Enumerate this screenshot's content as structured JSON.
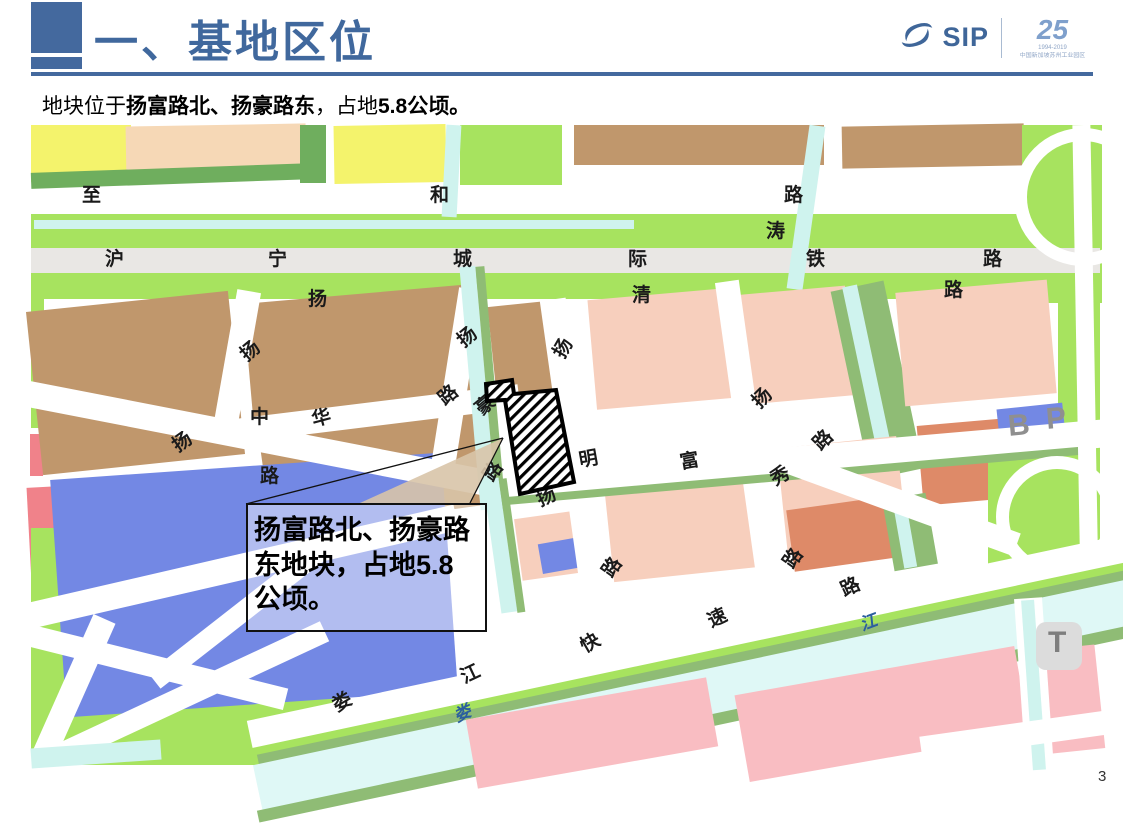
{
  "slide": {
    "title": "一、基地区位",
    "subtitle_segments": [
      {
        "text": "地块位于",
        "bold": false
      },
      {
        "text": "扬富路北、扬豪路东",
        "bold": true
      },
      {
        "text": "，占地",
        "bold": false
      },
      {
        "text": "5.8公顷。",
        "bold": true
      }
    ],
    "page_number": "3",
    "accent_color": "#44699E"
  },
  "logo": {
    "name": "SIP",
    "anniversary": "25",
    "anniversary_dates": "1994-2019",
    "anniversary_caption": "中国新加坡苏州工业园区",
    "color": "#3F6699",
    "light_color": "#7FA0CC"
  },
  "map": {
    "callout_text": "扬富路北、扬豪路东地块，占地5.8公顷。",
    "parcel": {
      "hatch_color": "#000000",
      "outline_color": "#000000",
      "fill": "#ffffff"
    },
    "palette": {
      "yellow": "#F4F36C",
      "peach": "#F6D8B6",
      "light_green": "#A7E35F",
      "dark_green": "#6FAE5E",
      "mid_green": "#8FBC75",
      "brown": "#C0976C",
      "blue": "#7388E4",
      "pink": "#F7CFBD",
      "rose": "#F9BDC2",
      "salmon": "#DE8A68",
      "red": "#F0828A",
      "canal": "#CFF3EE",
      "river": "#DFF8F6",
      "railway": "#E9E7E4",
      "road": "#FFFFFF",
      "badge": "#DCDCDC"
    },
    "blocks": [
      {
        "x": 31,
        "y": 125,
        "w": 100,
        "h": 57,
        "c": "#F4F36C"
      },
      {
        "x": 126,
        "y": 125,
        "w": 180,
        "h": 53,
        "c": "#F6D8B6",
        "r": -1
      },
      {
        "x": 31,
        "y": 168,
        "w": 282,
        "h": 16,
        "c": "#6FAE5E",
        "r": -2
      },
      {
        "x": 300,
        "y": 125,
        "w": 26,
        "h": 58,
        "c": "#6FAE5E"
      },
      {
        "x": 334,
        "y": 125,
        "w": 112,
        "h": 58,
        "c": "#F4F36C",
        "r": -1
      },
      {
        "x": 460,
        "y": 125,
        "w": 102,
        "h": 60,
        "c": "#A7E35F"
      },
      {
        "x": 574,
        "y": 125,
        "w": 250,
        "h": 40,
        "c": "#C0976C"
      },
      {
        "x": 842,
        "y": 125,
        "w": 182,
        "h": 42,
        "c": "#C0976C",
        "r": -1
      },
      {
        "x": 1022,
        "y": 125,
        "w": 80,
        "h": 178,
        "c": "#A7E35F"
      },
      {
        "x": 31,
        "y": 214,
        "w": 1069,
        "h": 34,
        "c": "#A7E35F"
      },
      {
        "x": 34,
        "y": 220,
        "w": 600,
        "h": 9,
        "c": "#CFF3EE"
      },
      {
        "x": 444,
        "y": 125,
        "w": 15,
        "h": 92,
        "c": "#CFF3EE",
        "r": 3
      },
      {
        "x": 31,
        "y": 248,
        "w": 1069,
        "h": 25,
        "c": "#E9E7E4",
        "n": "railway"
      },
      {
        "x": 31,
        "y": 273,
        "w": 1069,
        "h": 26,
        "c": "#A7E35F"
      },
      {
        "x": 798,
        "y": 125,
        "w": 16,
        "h": 165,
        "c": "#CFF3EE",
        "r": 8
      },
      {
        "x": 31,
        "y": 296,
        "w": 13,
        "h": 132,
        "c": "#A7E35F"
      },
      {
        "x": 30,
        "y": 434,
        "w": 13,
        "h": 42,
        "c": "#F0828A"
      },
      {
        "x": 30,
        "y": 487,
        "w": 28,
        "h": 133,
        "c": "#F0828A",
        "r": -3
      },
      {
        "x": 31,
        "y": 528,
        "w": 302,
        "h": 237,
        "c": "#A7E35F"
      },
      {
        "x": 34,
        "y": 301,
        "w": 203,
        "h": 164,
        "c": "#C0976C",
        "r": -6
      },
      {
        "x": 248,
        "y": 294,
        "w": 224,
        "h": 120,
        "c": "#C0976C",
        "r": -5
      },
      {
        "x": 264,
        "y": 414,
        "w": 218,
        "h": 106,
        "c": "#C0976C",
        "r": -8
      },
      {
        "x": 492,
        "y": 304,
        "w": 56,
        "h": 90,
        "c": "#C0976C",
        "r": -6
      },
      {
        "x": 58,
        "y": 466,
        "w": 392,
        "h": 238,
        "c": "#7388E4",
        "r": -4
      },
      {
        "x": 592,
        "y": 294,
        "w": 138,
        "h": 110,
        "c": "#F7CFBD",
        "r": -5
      },
      {
        "x": 744,
        "y": 290,
        "w": 106,
        "h": 110,
        "c": "#F7CFBD",
        "r": -5
      },
      {
        "x": 850,
        "y": 284,
        "w": 54,
        "h": 192,
        "c": "#8FBC75",
        "r": -12
      },
      {
        "x": 862,
        "y": 284,
        "w": 15,
        "h": 192,
        "c": "#CFF3EE",
        "r": -12
      },
      {
        "x": 900,
        "y": 286,
        "w": 152,
        "h": 114,
        "c": "#F7CFBD",
        "r": -5
      },
      {
        "x": 1058,
        "y": 275,
        "w": 42,
        "h": 300,
        "c": "#A7E35F"
      },
      {
        "x": 608,
        "y": 464,
        "w": 162,
        "h": 110,
        "c": "#F7CFBD",
        "r": -6
      },
      {
        "x": 782,
        "y": 442,
        "w": 120,
        "h": 106,
        "c": "#F7CFBD",
        "r": -6
      },
      {
        "x": 518,
        "y": 514,
        "w": 72,
        "h": 62,
        "c": "#F7CFBD",
        "r": -8
      },
      {
        "x": 540,
        "y": 540,
        "w": 48,
        "h": 30,
        "c": "#7388E4",
        "r": -10
      },
      {
        "x": 920,
        "y": 422,
        "w": 88,
        "h": 80,
        "c": "#DE8A68",
        "r": -5
      },
      {
        "x": 1072,
        "y": 422,
        "w": 26,
        "h": 66,
        "c": "#DE8A68",
        "r": -5
      },
      {
        "x": 988,
        "y": 436,
        "w": 112,
        "h": 150,
        "c": "#A7E35F"
      },
      {
        "x": 998,
        "y": 406,
        "w": 66,
        "h": 32,
        "c": "#7388E4",
        "r": -6
      },
      {
        "x": 790,
        "y": 503,
        "w": 102,
        "h": 62,
        "c": "#DE8A68",
        "r": -8
      },
      {
        "x": 888,
        "y": 496,
        "w": 44,
        "h": 72,
        "c": "#8FBC75",
        "r": -10
      },
      {
        "x": 898,
        "y": 496,
        "w": 13,
        "h": 72,
        "c": "#CFF3EE",
        "r": -10
      },
      {
        "x": 224,
        "y": 290,
        "w": 24,
        "h": 152,
        "c": "#FFFFFF",
        "r": 10,
        "n": "road"
      },
      {
        "x": 444,
        "y": 288,
        "w": 24,
        "h": 192,
        "c": "#FFFFFF",
        "r": 9,
        "n": "road"
      },
      {
        "x": 228,
        "y": 402,
        "w": 292,
        "h": 24,
        "c": "#FFFFFF",
        "r": -7,
        "n": "road"
      },
      {
        "x": 8,
        "y": 424,
        "w": 484,
        "h": 26,
        "c": "#FFFFFF",
        "r": 11,
        "n": "road"
      },
      {
        "x": 20,
        "y": 554,
        "w": 442,
        "h": 26,
        "c": "#FFFFFF",
        "r": -13,
        "n": "road"
      },
      {
        "x": 560,
        "y": 298,
        "w": 26,
        "h": 292,
        "c": "#FFFFFF",
        "r": -8,
        "n": "road"
      },
      {
        "x": 736,
        "y": 280,
        "w": 24,
        "h": 304,
        "c": "#FFFFFF",
        "r": -8,
        "n": "road"
      },
      {
        "x": 494,
        "y": 446,
        "w": 612,
        "h": 28,
        "c": "#FFFFFF",
        "r": -5,
        "n": "road"
      },
      {
        "x": 492,
        "y": 472,
        "w": 600,
        "h": 8,
        "c": "#8FBC75",
        "r": -5
      },
      {
        "x": 780,
        "y": 491,
        "w": 244,
        "h": 24,
        "c": "#FFFFFF",
        "r": 20,
        "n": "road"
      },
      {
        "x": 1014,
        "y": 128,
        "w": 112,
        "h": 112,
        "ring": true,
        "n": "ramp"
      },
      {
        "x": 996,
        "y": 456,
        "w": 96,
        "h": 96,
        "ring": true,
        "n": "interchange-loop"
      },
      {
        "x": 1078,
        "y": 125,
        "w": 18,
        "h": 645,
        "c": "#FFFFFF",
        "r": -1,
        "n": "road"
      },
      {
        "x": 470,
        "y": 266,
        "w": 16,
        "h": 244,
        "c": "#CFF3EE",
        "r": -5,
        "n": "canal"
      },
      {
        "x": 486,
        "y": 266,
        "w": 9,
        "h": 244,
        "c": "#8FBC75",
        "r": -5
      },
      {
        "x": 492,
        "y": 478,
        "w": 16,
        "h": 135,
        "c": "#CFF3EE",
        "r": -8,
        "n": "canal"
      },
      {
        "x": 508,
        "y": 478,
        "w": 8,
        "h": 135,
        "c": "#8FBC75",
        "r": -8
      },
      {
        "x": -10,
        "y": 652,
        "w": 300,
        "h": 22,
        "c": "#FFFFFF",
        "r": 14,
        "n": "road"
      },
      {
        "x": 60,
        "y": 612,
        "w": 24,
        "h": 160,
        "c": "#FFFFFF",
        "r": 24,
        "n": "road"
      },
      {
        "x": 10,
        "y": 690,
        "w": 330,
        "h": 22,
        "c": "#FFFFFF",
        "r": -25,
        "n": "road"
      },
      {
        "x": 130,
        "y": 600,
        "w": 230,
        "h": 20,
        "c": "#FFFFFF",
        "r": -38,
        "n": "road"
      },
      {
        "x": 240,
        "y": 626,
        "w": 910,
        "h": 30,
        "c": "#FFFFFF",
        "r": -12,
        "n": "expressway"
      },
      {
        "x": 240,
        "y": 654,
        "w": 910,
        "h": 10,
        "c": "#A7E35F",
        "r": -12
      },
      {
        "x": 248,
        "y": 658,
        "w": 930,
        "h": 12,
        "c": "#8FBC75",
        "r": -12
      },
      {
        "x": 248,
        "y": 668,
        "w": 930,
        "h": 50,
        "c": "#DFF8F6",
        "r": -12,
        "n": "river"
      },
      {
        "x": 248,
        "y": 714,
        "w": 930,
        "h": 12,
        "c": "#8FBC75",
        "r": -12
      },
      {
        "x": 470,
        "y": 698,
        "w": 244,
        "h": 70,
        "c": "#F9BDC2",
        "r": -10
      },
      {
        "x": 740,
        "y": 670,
        "w": 284,
        "h": 88,
        "c": "#F9BDC2",
        "r": -10
      },
      {
        "x": 1028,
        "y": 648,
        "w": 72,
        "h": 104,
        "c": "#F9BDC2",
        "r": -6
      },
      {
        "x": 1020,
        "y": 598,
        "w": 28,
        "h": 172,
        "c": "#FFFFFF",
        "r": -4,
        "n": "road"
      },
      {
        "x": 1027,
        "y": 600,
        "w": 13,
        "h": 170,
        "c": "#CFF3EE",
        "r": -4
      },
      {
        "x": 1036,
        "y": 622,
        "w": 46,
        "h": 48,
        "c": "#DCDCDC",
        "rad": 10,
        "n": "transit-badge"
      },
      {
        "x": 920,
        "y": 722,
        "w": 210,
        "h": 24,
        "c": "#FFFFFF",
        "r": -8,
        "n": "road"
      },
      {
        "x": 31,
        "y": 744,
        "w": 130,
        "h": 20,
        "c": "#CFF3EE",
        "r": -4
      }
    ],
    "labels": [
      {
        "t": "至",
        "x": 82,
        "y": 186
      },
      {
        "t": "和",
        "x": 430,
        "y": 186
      },
      {
        "t": "路",
        "x": 784,
        "y": 186
      },
      {
        "t": "涛",
        "x": 766,
        "y": 222
      },
      {
        "t": "沪",
        "x": 105,
        "y": 250,
        "b": true
      },
      {
        "t": "宁",
        "x": 268,
        "y": 250,
        "b": true
      },
      {
        "t": "城",
        "x": 453,
        "y": 250,
        "b": true
      },
      {
        "t": "际",
        "x": 628,
        "y": 250,
        "b": true
      },
      {
        "t": "铁",
        "x": 806,
        "y": 250,
        "b": true
      },
      {
        "t": "路",
        "x": 983,
        "y": 250,
        "b": true
      },
      {
        "t": "扬",
        "x": 308,
        "y": 290
      },
      {
        "t": "清",
        "x": 632,
        "y": 286
      },
      {
        "t": "路",
        "x": 944,
        "y": 281
      },
      {
        "t": "扬",
        "x": 241,
        "y": 342,
        "r": -40
      },
      {
        "t": "扬",
        "x": 458,
        "y": 328,
        "r": -40
      },
      {
        "t": "扬",
        "x": 554,
        "y": 339,
        "r": -60
      },
      {
        "t": "路",
        "x": 439,
        "y": 386,
        "r": -40
      },
      {
        "t": "豪",
        "x": 476,
        "y": 396,
        "r": -40
      },
      {
        "t": "中",
        "x": 250,
        "y": 408
      },
      {
        "t": "华",
        "x": 312,
        "y": 409,
        "r": -15
      },
      {
        "t": "扬",
        "x": 173,
        "y": 433,
        "r": -35
      },
      {
        "t": "扬",
        "x": 753,
        "y": 389,
        "r": -45
      },
      {
        "t": "路",
        "x": 260,
        "y": 467
      },
      {
        "t": "路",
        "x": 484,
        "y": 462,
        "r": -55
      },
      {
        "t": "明",
        "x": 579,
        "y": 450,
        "r": -10
      },
      {
        "t": "富",
        "x": 680,
        "y": 452,
        "r": -10
      },
      {
        "t": "路",
        "x": 814,
        "y": 431,
        "r": -45
      },
      {
        "t": "秀",
        "x": 771,
        "y": 467,
        "r": -30
      },
      {
        "t": "扬",
        "x": 537,
        "y": 488,
        "r": -25
      },
      {
        "t": "路",
        "x": 603,
        "y": 558,
        "r": -55
      },
      {
        "t": "路",
        "x": 784,
        "y": 549,
        "r": -55
      },
      {
        "t": "娄",
        "x": 333,
        "y": 693,
        "r": -30
      },
      {
        "t": "江",
        "x": 461,
        "y": 665,
        "r": -25
      },
      {
        "t": "快",
        "x": 581,
        "y": 634,
        "r": -30
      },
      {
        "t": "速",
        "x": 708,
        "y": 609,
        "r": -25
      },
      {
        "t": "路",
        "x": 841,
        "y": 578,
        "r": -25
      },
      {
        "t": "娄",
        "x": 454,
        "y": 705,
        "r": -25,
        "s": 17,
        "c": "#2B5F9E",
        "b": true,
        "i": true,
        "n": "river-name"
      },
      {
        "t": "江",
        "x": 860,
        "y": 614,
        "r": -20,
        "s": 17,
        "c": "#2B5F9E",
        "b": true,
        "i": true,
        "n": "river-name"
      },
      {
        "t": "B",
        "x": 1008,
        "y": 411,
        "r": -5,
        "s": 30,
        "c": "#8F8F8F",
        "b": true,
        "n": "poi-b"
      },
      {
        "t": "P",
        "x": 1046,
        "y": 404,
        "r": -5,
        "s": 30,
        "c": "#8F8F8F",
        "b": true,
        "n": "poi-parking"
      },
      {
        "t": "T",
        "x": 1048,
        "y": 628,
        "s": 30,
        "c": "#7E7E7E",
        "b": true,
        "n": "poi-transit"
      }
    ]
  }
}
